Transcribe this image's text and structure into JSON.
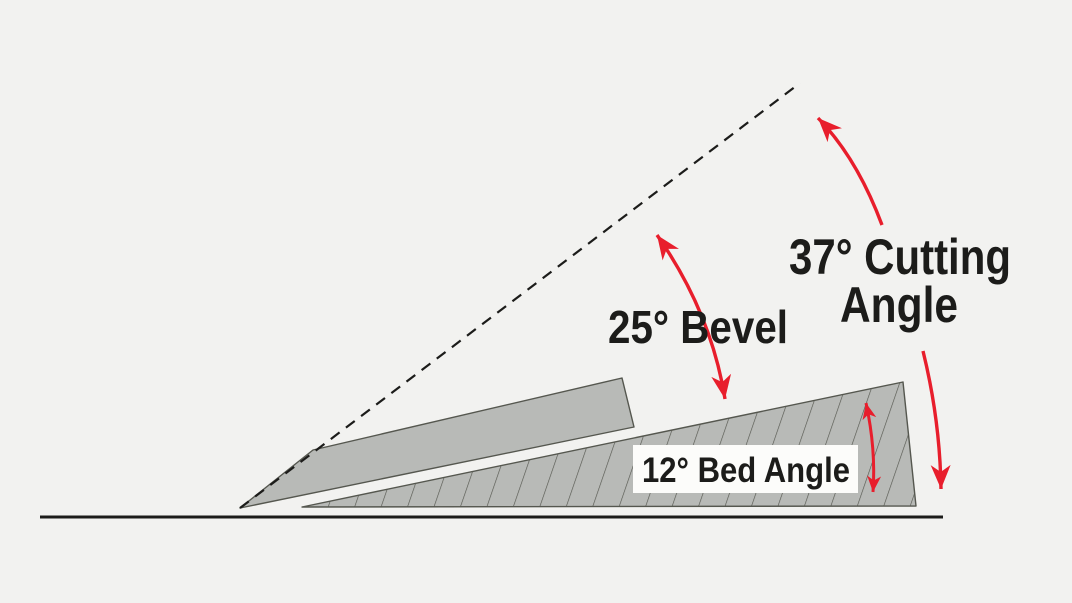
{
  "labels": {
    "cutting_angle": {
      "line1": "37° Cutting",
      "line2": "Angle"
    },
    "bevel": {
      "text": "25° Bevel"
    },
    "bed": {
      "text": "12° Bed Angle"
    }
  },
  "angles": {
    "cutting_deg": 37,
    "bevel_deg": 25,
    "bed_deg": 12
  },
  "colors": {
    "background": "#f2f2f0",
    "shape_fill": "#b8bab7",
    "shape_outline": "#55574f",
    "hatch_line": "#55574f",
    "arrow_red": "#e81e2c",
    "ink": "#1c1c1a",
    "label_box": "#fcfcfa"
  }
}
